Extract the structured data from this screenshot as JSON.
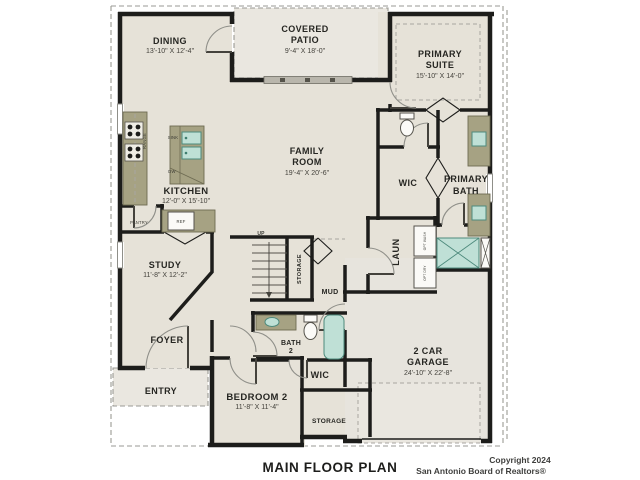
{
  "plan": {
    "footer": {
      "title": "MAIN FLOOR PLAN",
      "copyright_line1": "Copyright 2024",
      "copyright_line2": "San Antonio Board of Realtors®"
    },
    "rooms": {
      "dining": {
        "name": "DINING",
        "dims": "13'-10\" X 12'-4\""
      },
      "covered_patio": {
        "name_line1": "COVERED",
        "name_line2": "PATIO",
        "dims": "9'-4\" X 18'-0\""
      },
      "primary_suite": {
        "name_line1": "PRIMARY",
        "name_line2": "SUITE",
        "dims": "15'-10\" X 14'-0\""
      },
      "family_room": {
        "name_line1": "FAMILY",
        "name_line2": "ROOM",
        "dims": "19'-4\" X 20'-6\""
      },
      "kitchen": {
        "name": "KITCHEN",
        "dims": "12'-0\" X 15'-10\""
      },
      "primary_wic": {
        "name": "WIC"
      },
      "primary_bath": {
        "name_line1": "PRIMARY",
        "name_line2": "BATH"
      },
      "study": {
        "name": "STUDY",
        "dims": "11'-8\" X 12'-2\""
      },
      "laundry": {
        "name": "LAUN"
      },
      "mud": {
        "name": "MUD"
      },
      "stair_storage": {
        "name": "STORAGE"
      },
      "foyer": {
        "name": "FOYER"
      },
      "entry": {
        "name": "ENTRY"
      },
      "bath2": {
        "name_line1": "BATH",
        "name_line2": "2"
      },
      "bedroom2": {
        "name": "BEDROOM 2",
        "dims": "11'-8\" X 11'-4\""
      },
      "bedroom2_wic": {
        "name": "WIC"
      },
      "garage": {
        "name_line1": "2 CAR",
        "name_line2": "GARAGE",
        "dims": "24'-10\" X 22'-8\""
      },
      "garage_storage": {
        "name": "STORAGE"
      }
    },
    "fixture_labels": {
      "range": "RANGE",
      "sink": "SINK",
      "dw": "DW",
      "ref": "REF",
      "pantry": "PANTRY",
      "up": "UP",
      "opt_washer": "OPT WASH",
      "opt_dryer": "OPT DRY"
    },
    "colors": {
      "floor": "#e6e2d8",
      "outdoor": "#eae7e0",
      "wall": "#1d1d1b",
      "cabinet": "#a6a283",
      "fixture_teal": "#bfe0d6",
      "dash_gray": "#9a9a94"
    }
  }
}
